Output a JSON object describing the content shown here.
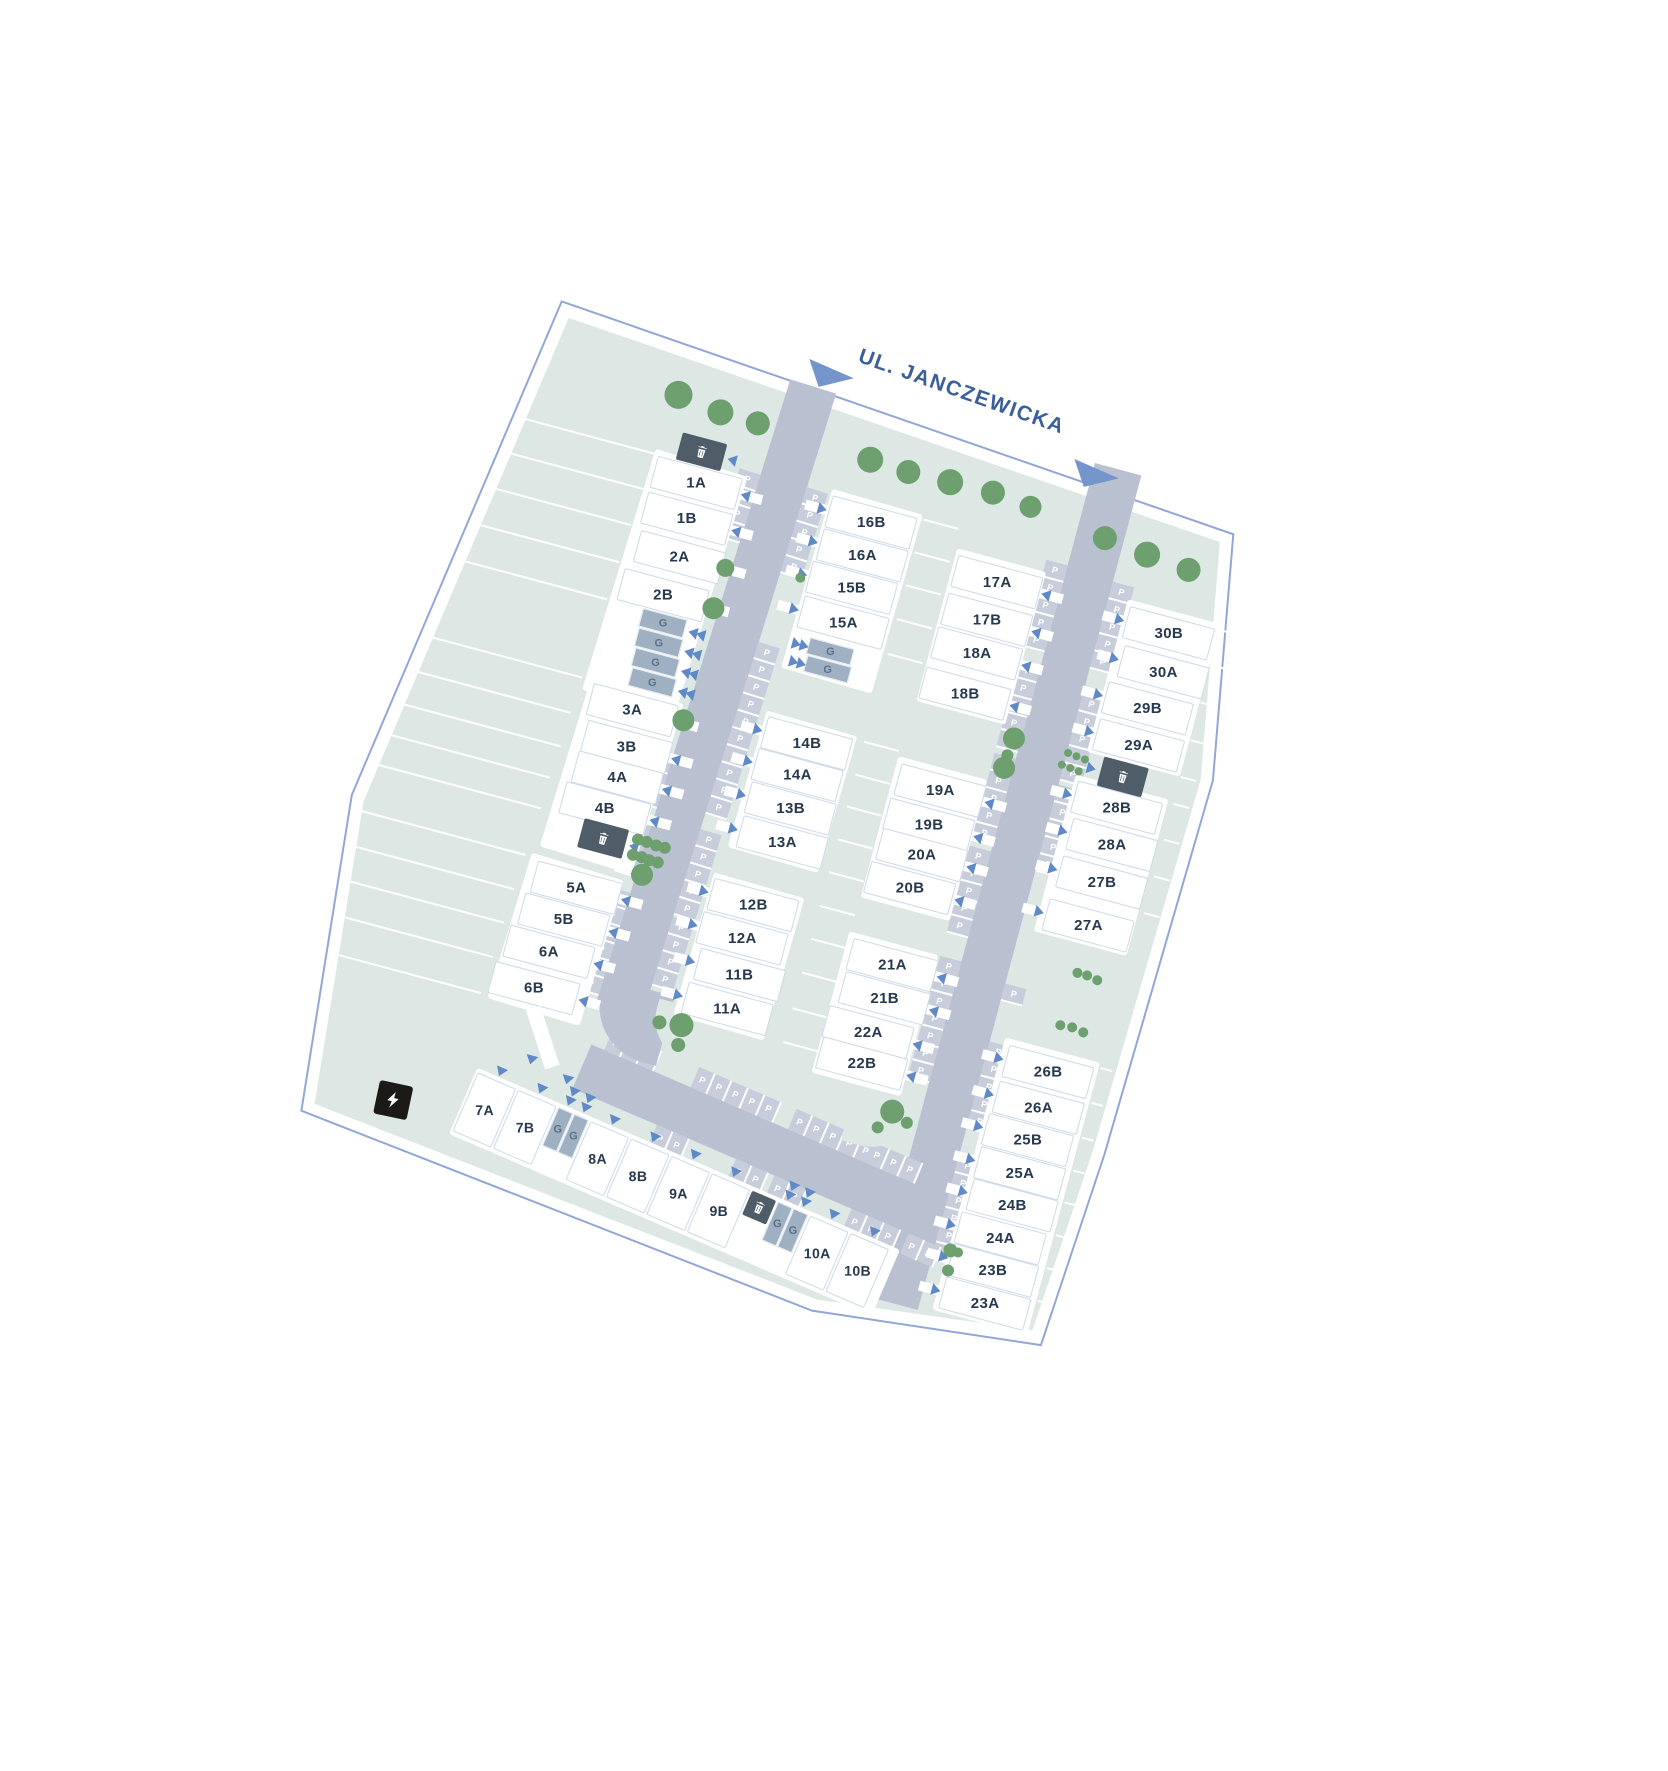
{
  "title": "Osiedle site plan",
  "street": {
    "label": "UL. JANCZEWICKA",
    "label_x": 398,
    "label_y": -22,
    "arrows": [
      {
        "x": 351,
        "y": -8,
        "w": 48,
        "h": 30
      },
      {
        "x": 633,
        "y": 20,
        "w": 48,
        "h": 30
      }
    ]
  },
  "colors": {
    "road": "#b9c1d1",
    "stall": "#c7cdda",
    "lawn": "#dde8e4",
    "tree": "#6d9f6f",
    "boundary": "#92a7d7",
    "house_label": "#26394f",
    "garage": "#9fb0c2",
    "bin": "#4e5d68",
    "street_text": "#3b5f99",
    "arrow": "#6089c8",
    "triangle": "#7495cc",
    "ev": "#1b1a17"
  },
  "boundary_points": "97,6 806,57 850,300 842,690 830,890 600,916 55,855 22,537",
  "lawn_points": "108,20 795,68 838,302 830,688 818,878 602,904 66,845 35,540",
  "roads": {
    "left": {
      "x": 338,
      "y": 22,
      "w": 48,
      "h": 650,
      "rot": 2.3
    },
    "right": {
      "x": 654,
      "y": 24,
      "w": 48,
      "h": 864,
      "rot": 0
    },
    "bottom": {
      "x": 318,
      "y": 716,
      "w": 356,
      "h": 48,
      "rot": 8.3
    },
    "bend": {
      "x": 314,
      "y": 648,
      "w": 72,
      "h": 72,
      "radius": "0 0 0 58px"
    },
    "wedges": [
      {
        "x": 372,
        "y": 654,
        "w": 66,
        "h": 54,
        "radius": "0 0 0 44px"
      },
      {
        "x": 584,
        "y": 686,
        "w": 68,
        "h": 58,
        "radius": "0 0 50px 0"
      }
    ]
  },
  "stalls": {
    "size": {
      "along": 18,
      "deep": 22
    },
    "left": {
      "west": [
        [
          100,
          4
        ],
        [
          396,
          3
        ],
        [
          468,
          3
        ],
        [
          538,
          6
        ]
      ],
      "east": [
        [
          98,
          5
        ],
        [
          260,
          5
        ],
        [
          350,
          5
        ],
        [
          456,
          5
        ],
        [
          548,
          4
        ]
      ]
    },
    "right": {
      "west": [
        [
          106,
          5
        ],
        [
          210,
          5
        ],
        [
          306,
          5
        ],
        [
          402,
          5
        ],
        [
          516,
          7
        ],
        [
          766,
          5
        ]
      ],
      "east": [
        [
          110,
          5
        ],
        [
          226,
          5
        ],
        [
          320,
          5
        ],
        [
          526,
          1
        ],
        [
          586,
          5
        ],
        [
          704,
          6
        ]
      ]
    },
    "bottom": {
      "north": [
        [
          14,
          3
        ],
        [
          108,
          5
        ],
        [
          214,
          5
        ],
        [
          298,
          3
        ]
      ],
      "south": [
        [
          92,
          2
        ],
        [
          178,
          2
        ],
        [
          220,
          2
        ],
        [
          304,
          3
        ],
        [
          366,
          2
        ]
      ]
    },
    "p_label": "P"
  },
  "bands": [
    {
      "x": 226,
      "y": 124,
      "w": 96,
      "h": 252,
      "rot": 2
    },
    {
      "x": 223,
      "y": 360,
      "w": 96,
      "h": 178,
      "rot": 2
    },
    {
      "x": 211,
      "y": 546,
      "w": 96,
      "h": 152,
      "rot": 2
    },
    {
      "x": 407,
      "y": 117,
      "w": 94,
      "h": 186,
      "rot": 1
    },
    {
      "x": 401,
      "y": 348,
      "w": 94,
      "h": 142,
      "rot": 1
    },
    {
      "x": 392,
      "y": 518,
      "w": 94,
      "h": 148,
      "rot": 1
    },
    {
      "x": 543,
      "y": 142,
      "w": 92,
      "h": 158,
      "rot": 0
    },
    {
      "x": 540,
      "y": 358,
      "w": 92,
      "h": 146,
      "rot": 0
    },
    {
      "x": 538,
      "y": 540,
      "w": 92,
      "h": 146,
      "rot": 0
    },
    {
      "x": 721,
      "y": 147,
      "w": 96,
      "h": 158,
      "rot": 0
    },
    {
      "x": 716,
      "y": 330,
      "w": 96,
      "h": 162,
      "rot": 0
    },
    {
      "x": 716,
      "y": 602,
      "w": 98,
      "h": 282,
      "rot": 0
    }
  ],
  "houses": [
    {
      "label": "1A",
      "cx": 274,
      "cy": 146,
      "side": "w"
    },
    {
      "label": "1B",
      "cx": 274,
      "cy": 183,
      "side": "w"
    },
    {
      "label": "2A",
      "cx": 277,
      "cy": 222,
      "side": "w"
    },
    {
      "label": "2B",
      "cx": 271,
      "cy": 263,
      "side": "w"
    },
    {
      "label": "3A",
      "cx": 271,
      "cy": 382,
      "side": "w"
    },
    {
      "label": "3B",
      "cx": 275,
      "cy": 419,
      "side": "w"
    },
    {
      "label": "4A",
      "cx": 274,
      "cy": 451,
      "side": "w"
    },
    {
      "label": "4B",
      "cx": 270,
      "cy": 484,
      "side": "w"
    },
    {
      "label": "5A",
      "cx": 263,
      "cy": 568,
      "side": "w"
    },
    {
      "label": "5B",
      "cx": 259,
      "cy": 602,
      "side": "w"
    },
    {
      "label": "6A",
      "cx": 253,
      "cy": 637,
      "side": "w"
    },
    {
      "label": "6B",
      "cx": 248,
      "cy": 676,
      "side": "w"
    },
    {
      "label": "16B",
      "cx": 453,
      "cy": 139,
      "side": "e"
    },
    {
      "label": "16A",
      "cx": 453,
      "cy": 173,
      "side": "e"
    },
    {
      "label": "15B",
      "cx": 451,
      "cy": 207,
      "side": "e"
    },
    {
      "label": "15A",
      "cx": 452,
      "cy": 243,
      "side": "e"
    },
    {
      "label": "14B",
      "cx": 448,
      "cy": 369,
      "side": "e"
    },
    {
      "label": "14A",
      "cx": 447,
      "cy": 402,
      "side": "e"
    },
    {
      "label": "13B",
      "cx": 449,
      "cy": 436,
      "side": "e"
    },
    {
      "label": "13A",
      "cx": 450,
      "cy": 471,
      "side": "e"
    },
    {
      "label": "12B",
      "cx": 438,
      "cy": 539,
      "side": "e"
    },
    {
      "label": "12A",
      "cx": 436,
      "cy": 574,
      "side": "e"
    },
    {
      "label": "11B",
      "cx": 443,
      "cy": 610,
      "side": "e"
    },
    {
      "label": "11A",
      "cx": 440,
      "cy": 646,
      "side": "e"
    },
    {
      "label": "17A",
      "cx": 590,
      "cy": 164,
      "side": "w"
    },
    {
      "label": "17B",
      "cx": 590,
      "cy": 203,
      "side": "w"
    },
    {
      "label": "18A",
      "cx": 589,
      "cy": 238,
      "side": "w"
    },
    {
      "label": "18B",
      "cx": 588,
      "cy": 280,
      "side": "w"
    },
    {
      "label": "19A",
      "cx": 589,
      "cy": 380,
      "side": "w"
    },
    {
      "label": "19B",
      "cx": 587,
      "cy": 416,
      "side": "w"
    },
    {
      "label": "20A",
      "cx": 588,
      "cy": 447,
      "side": "w"
    },
    {
      "label": "20B",
      "cx": 585,
      "cy": 482,
      "side": "w"
    },
    {
      "label": "21A",
      "cx": 588,
      "cy": 561,
      "side": "w"
    },
    {
      "label": "21B",
      "cx": 589,
      "cy": 595,
      "side": "w"
    },
    {
      "label": "22A",
      "cx": 582,
      "cy": 632,
      "side": "w"
    },
    {
      "label": "22B",
      "cx": 584,
      "cy": 664,
      "side": "w"
    },
    {
      "label": "30B",
      "cx": 769,
      "cy": 169,
      "side": "e"
    },
    {
      "label": "30A",
      "cx": 774,
      "cy": 208,
      "side": "e"
    },
    {
      "label": "29B",
      "cx": 768,
      "cy": 247,
      "side": "e"
    },
    {
      "label": "29A",
      "cx": 769,
      "cy": 285,
      "side": "e"
    },
    {
      "label": "28B",
      "cx": 764,
      "cy": 351,
      "side": "e"
    },
    {
      "label": "28A",
      "cx": 769,
      "cy": 388,
      "side": "e"
    },
    {
      "label": "27B",
      "cx": 769,
      "cy": 427,
      "side": "e"
    },
    {
      "label": "27A",
      "cx": 767,
      "cy": 472,
      "side": "e"
    },
    {
      "label": "26B",
      "cx": 766,
      "cy": 624,
      "side": "e"
    },
    {
      "label": "26A",
      "cx": 766,
      "cy": 661,
      "side": "e"
    },
    {
      "label": "25B",
      "cx": 764,
      "cy": 695,
      "side": "e"
    },
    {
      "label": "25A",
      "cx": 765,
      "cy": 729,
      "side": "e"
    },
    {
      "label": "24B",
      "cx": 766,
      "cy": 762,
      "side": "e"
    },
    {
      "label": "24A",
      "cx": 763,
      "cy": 797,
      "side": "e"
    },
    {
      "label": "23B",
      "cx": 764,
      "cy": 830,
      "side": "e"
    },
    {
      "label": "23A",
      "cx": 765,
      "cy": 864,
      "side": "e"
    }
  ],
  "house_size": {
    "w": 88,
    "h": 33
  },
  "garages": [
    {
      "x": 255,
      "y": 281,
      "w": 46,
      "h": 19,
      "chev": "w"
    },
    {
      "x": 256,
      "y": 301,
      "w": 46,
      "h": 19,
      "chev": "w"
    },
    {
      "x": 258,
      "y": 321,
      "w": 46,
      "h": 19,
      "chev": "w"
    },
    {
      "x": 260,
      "y": 341,
      "w": 46,
      "h": 19,
      "chev": "w"
    },
    {
      "x": 424,
      "y": 266,
      "w": 46,
      "h": 17,
      "chev": "e"
    },
    {
      "x": 426,
      "y": 284,
      "w": 46,
      "h": 17,
      "chev": "e"
    }
  ],
  "garage_label": "G",
  "bins": [
    {
      "x": 248,
      "y": 101,
      "w": 46,
      "h": 28,
      "arrow": "w"
    },
    {
      "x": 253,
      "y": 499,
      "w": 46,
      "h": 30,
      "arrow": "w"
    },
    {
      "x": 739,
      "y": 305,
      "w": 46,
      "h": 30,
      "arrow": "e"
    }
  ],
  "bottom_band": {
    "x": 214,
    "y": 768,
    "w": 460,
    "h": 72,
    "rot": 8.3,
    "items": [
      {
        "t": "h",
        "label": "7A",
        "x": 2
      },
      {
        "t": "h",
        "label": "7B",
        "x": 46
      },
      {
        "t": "g",
        "x": 90
      },
      {
        "t": "g",
        "x": 107
      },
      {
        "t": "h",
        "label": "8A",
        "x": 125
      },
      {
        "t": "h",
        "label": "8B",
        "x": 169
      },
      {
        "t": "h",
        "label": "9A",
        "x": 213
      },
      {
        "t": "h",
        "label": "9B",
        "x": 257
      },
      {
        "t": "b",
        "x": 301
      },
      {
        "t": "g",
        "x": 329
      },
      {
        "t": "g",
        "x": 346
      },
      {
        "t": "h",
        "label": "10A",
        "x": 364
      },
      {
        "t": "h",
        "label": "10B",
        "x": 408
      }
    ],
    "house": {
      "w": 42,
      "h": 64
    },
    "garage": {
      "w": 16,
      "h": 42
    },
    "bin": {
      "w": 26,
      "h": 26
    }
  },
  "trees": [
    {
      "x": 234,
      "y": 66,
      "r": 14
    },
    {
      "x": 279,
      "y": 72,
      "r": 13
    },
    {
      "x": 318,
      "y": 73,
      "r": 12
    },
    {
      "x": 436,
      "y": 79,
      "r": 13
    },
    {
      "x": 476,
      "y": 81,
      "r": 12
    },
    {
      "x": 519,
      "y": 80,
      "r": 13
    },
    {
      "x": 563,
      "y": 79,
      "r": 12
    },
    {
      "x": 603,
      "y": 83,
      "r": 11
    },
    {
      "x": 683,
      "y": 94,
      "r": 12
    },
    {
      "x": 728,
      "y": 99,
      "r": 13
    },
    {
      "x": 772,
      "y": 103,
      "r": 12
    },
    {
      "x": 324,
      "y": 221,
      "r": 9
    },
    {
      "x": 323,
      "y": 263,
      "r": 11
    },
    {
      "x": 323,
      "y": 379,
      "r": 11
    },
    {
      "x": 399,
      "y": 211,
      "r": 5
    },
    {
      "x": 310,
      "y": 506,
      "r": 6
    },
    {
      "x": 319,
      "y": 506,
      "r": 6
    },
    {
      "x": 329,
      "y": 507,
      "r": 6
    },
    {
      "x": 338,
      "y": 507,
      "r": 6
    },
    {
      "x": 309,
      "y": 522,
      "r": 6
    },
    {
      "x": 318,
      "y": 522,
      "r": 6
    },
    {
      "x": 326,
      "y": 523,
      "r": 6
    },
    {
      "x": 335,
      "y": 523,
      "r": 6
    },
    {
      "x": 323,
      "y": 539,
      "r": 11
    },
    {
      "x": 378,
      "y": 677,
      "r": 7
    },
    {
      "x": 400,
      "y": 674,
      "r": 12
    },
    {
      "x": 402,
      "y": 694,
      "r": 7
    },
    {
      "x": 647,
      "y": 311,
      "r": 11
    },
    {
      "x": 645,
      "y": 329,
      "r": 6
    },
    {
      "x": 645,
      "y": 342,
      "r": 11
    },
    {
      "x": 703,
      "y": 311,
      "r": 4
    },
    {
      "x": 712,
      "y": 312,
      "r": 4
    },
    {
      "x": 721,
      "y": 313,
      "r": 4
    },
    {
      "x": 700,
      "y": 324,
      "r": 4
    },
    {
      "x": 709,
      "y": 325,
      "r": 4
    },
    {
      "x": 718,
      "y": 326,
      "r": 4
    },
    {
      "x": 769,
      "y": 521,
      "r": 5
    },
    {
      "x": 779,
      "y": 521,
      "r": 5
    },
    {
      "x": 790,
      "y": 523,
      "r": 5
    },
    {
      "x": 766,
      "y": 576,
      "r": 5
    },
    {
      "x": 778,
      "y": 575,
      "r": 5
    },
    {
      "x": 790,
      "y": 577,
      "r": 5
    },
    {
      "x": 626,
      "y": 703,
      "r": 12
    },
    {
      "x": 616,
      "y": 722,
      "r": 6
    },
    {
      "x": 643,
      "y": 710,
      "r": 6
    },
    {
      "x": 718,
      "y": 822,
      "r": 7
    },
    {
      "x": 726,
      "y": 822,
      "r": 5
    },
    {
      "x": 721,
      "y": 842,
      "r": 6
    }
  ],
  "parcel_lines": [
    [
      88,
      128,
      138
    ],
    [
      82,
      165,
      142
    ],
    [
      77,
      203,
      145
    ],
    [
      72,
      242,
      148
    ],
    [
      66,
      281,
      152
    ],
    [
      55,
      363,
      159
    ],
    [
      49,
      400,
      163
    ],
    [
      44,
      435,
      167
    ],
    [
      40,
      468,
      169
    ],
    [
      35,
      500,
      173
    ],
    [
      31,
      549,
      174
    ],
    [
      35,
      585,
      168
    ],
    [
      39,
      620,
      163
    ],
    [
      42,
      656,
      158
    ],
    [
      46,
      694,
      152
    ],
    [
      503,
      122,
      36
    ],
    [
      503,
      156,
      36
    ],
    [
      503,
      190,
      36
    ],
    [
      503,
      225,
      36
    ],
    [
      503,
      261,
      36
    ],
    [
      503,
      352,
      36
    ],
    [
      503,
      386,
      36
    ],
    [
      503,
      419,
      36
    ],
    [
      503,
      453,
      36
    ],
    [
      503,
      487,
      36
    ],
    [
      503,
      522,
      36
    ],
    [
      503,
      556,
      36
    ],
    [
      503,
      591,
      36
    ],
    [
      503,
      628,
      36
    ],
    [
      503,
      663,
      36
    ],
    [
      818,
      152,
      16
    ],
    [
      818,
      188,
      16
    ],
    [
      818,
      227,
      16
    ],
    [
      818,
      266,
      16
    ],
    [
      818,
      304,
      16
    ],
    [
      818,
      332,
      16
    ],
    [
      818,
      369,
      16
    ],
    [
      818,
      407,
      16
    ],
    [
      818,
      445,
      16
    ],
    [
      816,
      606,
      12
    ],
    [
      816,
      642,
      12
    ],
    [
      816,
      678,
      12
    ],
    [
      816,
      712,
      12
    ],
    [
      816,
      745,
      12
    ],
    [
      816,
      779,
      12
    ],
    [
      816,
      813,
      12
    ],
    [
      816,
      847,
      12
    ]
  ],
  "walkway": {
    "x": 246,
    "y": 700,
    "w": 15,
    "h": 62,
    "rot": -33,
    "arrows": [
      {
        "x": 258,
        "y": 742
      },
      {
        "x": 298,
        "y": 752
      }
    ]
  },
  "ev": {
    "x": 124,
    "y": 804,
    "w": 34,
    "h": 34
  }
}
